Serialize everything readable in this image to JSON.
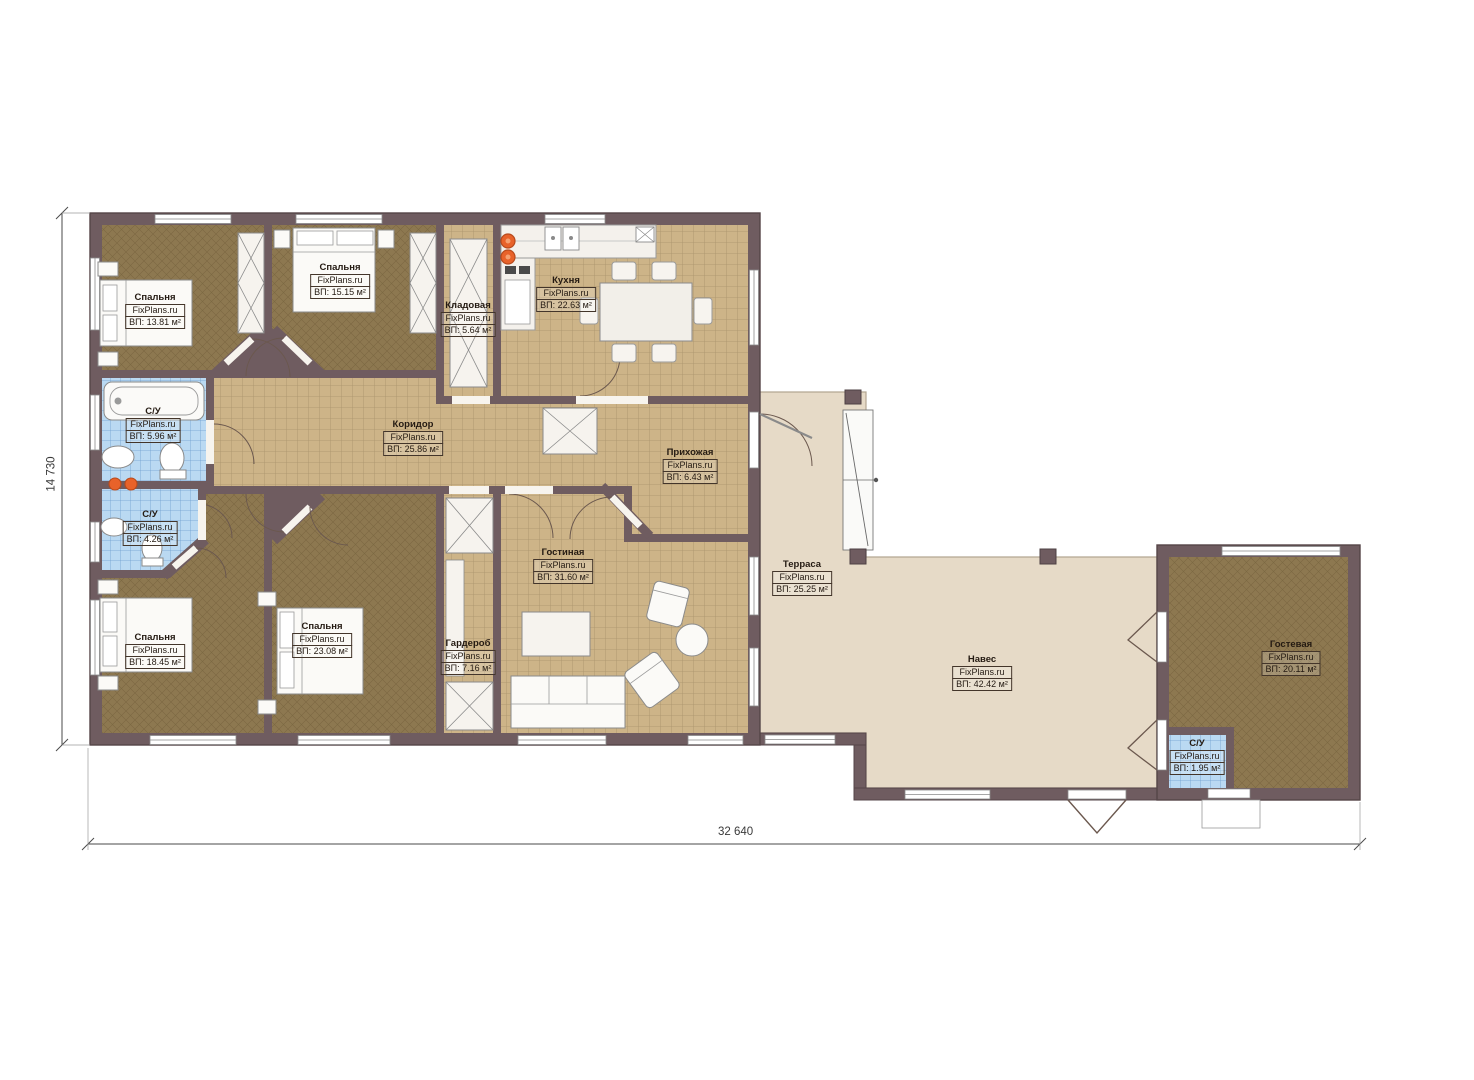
{
  "plan": {
    "brand": "FixPlans.ru",
    "dimensions": {
      "width_label": "32 640",
      "height_label": "14 730"
    },
    "colors": {
      "wall": "#6f5c60",
      "tile_floor": "#cdb488",
      "blue_tile": "#bad9f2",
      "carpet": "#8d7850",
      "terrace": "#e6dac7",
      "accent_burner": "#e8622a"
    },
    "rooms": [
      {
        "id": "bedroom-top-left",
        "name": "Спальня",
        "brand": "FixPlans.ru",
        "area": "ВП: 13.81 м²"
      },
      {
        "id": "bedroom-top",
        "name": "Спальня",
        "brand": "FixPlans.ru",
        "area": "ВП: 15.15 м²"
      },
      {
        "id": "storage",
        "name": "Кладовая",
        "brand": "FixPlans.ru",
        "area": "ВП: 5.64 м²"
      },
      {
        "id": "kitchen",
        "name": "Кухня",
        "brand": "FixPlans.ru",
        "area": "ВП: 22.63 м²"
      },
      {
        "id": "bathroom-top",
        "name": "С/У",
        "brand": "FixPlans.ru",
        "area": "ВП: 5.96 м²"
      },
      {
        "id": "corridor",
        "name": "Коридор",
        "brand": "FixPlans.ru",
        "area": "ВП: 25.86 м²"
      },
      {
        "id": "hallway",
        "name": "Прихожая",
        "brand": "FixPlans.ru",
        "area": "ВП: 6.43 м²"
      },
      {
        "id": "bathroom-mid",
        "name": "С/У",
        "brand": "FixPlans.ru",
        "area": "ВП: 4.26 м²"
      },
      {
        "id": "bedroom-bottom-left",
        "name": "Спальня",
        "brand": "FixPlans.ru",
        "area": "ВП: 18.45 м²"
      },
      {
        "id": "bedroom-bottom",
        "name": "Спальня",
        "brand": "FixPlans.ru",
        "area": "ВП: 23.08 м²"
      },
      {
        "id": "wardrobe",
        "name": "Гардероб",
        "brand": "FixPlans.ru",
        "area": "ВП: 7.16 м²"
      },
      {
        "id": "living-room",
        "name": "Гостиная",
        "brand": "FixPlans.ru",
        "area": "ВП: 31.60 м²"
      },
      {
        "id": "terrace",
        "name": "Терраса",
        "brand": "FixPlans.ru",
        "area": "ВП: 25.25 м²"
      },
      {
        "id": "canopy",
        "name": "Навес",
        "brand": "FixPlans.ru",
        "area": "ВП: 42.42 м²"
      },
      {
        "id": "guest-room",
        "name": "Гостевая",
        "brand": "FixPlans.ru",
        "area": "ВП: 20.11 м²"
      },
      {
        "id": "bathroom-guest",
        "name": "С/У",
        "brand": "FixPlans.ru",
        "area": "ВП: 1.95 м²"
      }
    ]
  }
}
